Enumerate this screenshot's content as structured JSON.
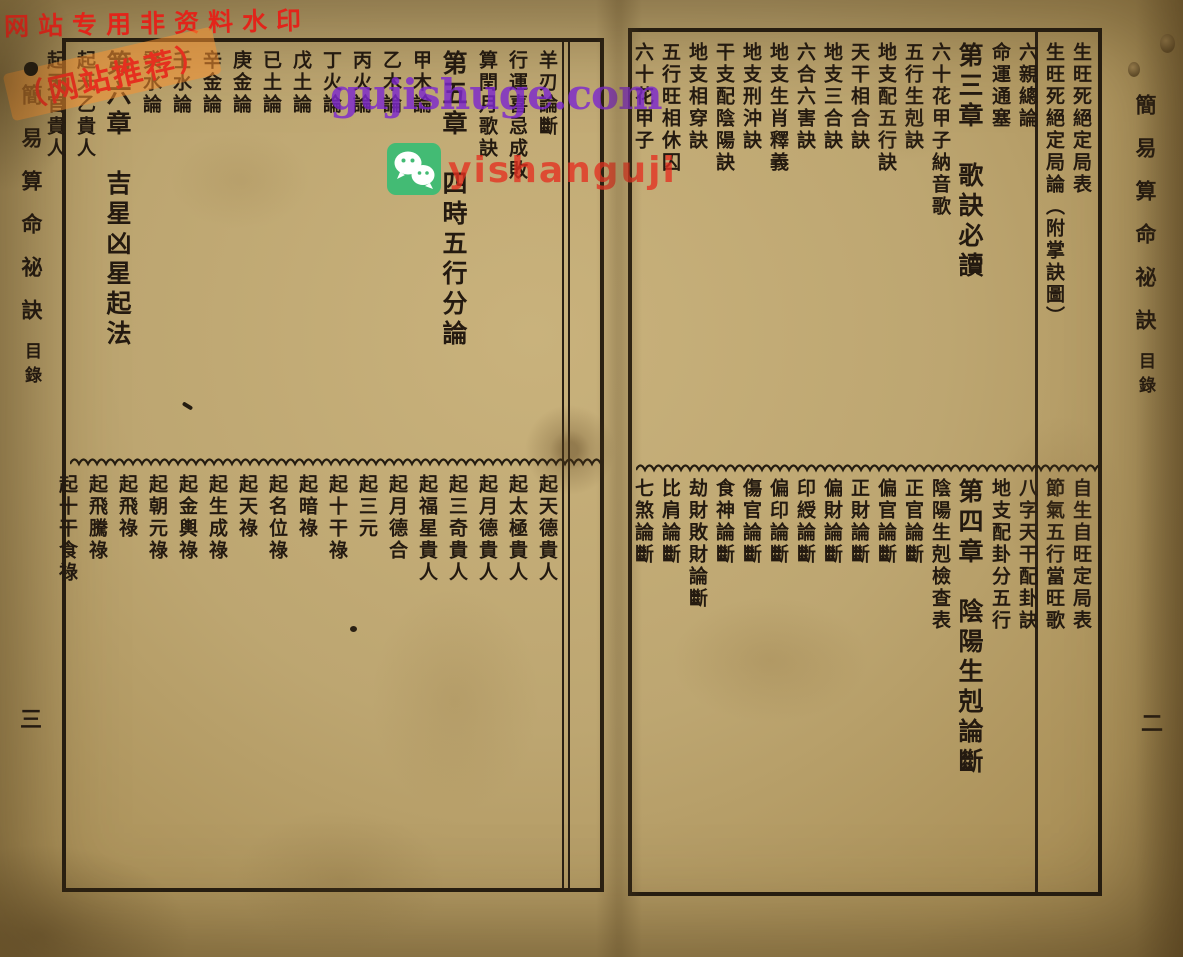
{
  "book": {
    "margin_title": "簡易算命祕訣",
    "margin_subtitle": "目錄",
    "left_page_number": "三",
    "right_page_number": "二"
  },
  "right_page": {
    "top_entries": [
      "生旺死絕定局表",
      "生旺死絕定局論（附掌訣圖）",
      "六親總論",
      "命運通塞",
      "第三章　歌訣必讀",
      "六十花甲子納音歌",
      "五行生剋訣",
      "地支配五行訣",
      "天干相合訣",
      "地支三合訣",
      "六合六害訣",
      "地支生肖釋義",
      "地支刑沖訣",
      "干支配陰陽訣",
      "地支相穿訣",
      "五行旺相休囚",
      "六十花甲子"
    ],
    "bottom_entries": [
      "自生自旺定局表",
      "節氣五行當旺歌",
      "八字天干配卦訣",
      "地支配卦分五行",
      "第四章　陰陽生剋論斷",
      "陰陽生剋檢查表",
      "正官論斷",
      "偏官論斷",
      "正財論斷",
      "偏財論斷",
      "印綬論斷",
      "偏印論斷",
      "傷官論斷",
      "食神論斷",
      "劫財敗財論斷",
      "比肩論斷",
      "七煞論斷"
    ]
  },
  "left_page": {
    "top_entries": [
      "羊刃論斷",
      "行運喜忌成敗",
      "算閏月歌訣",
      "第五章　四時五行分論",
      "甲木論",
      "乙木論",
      "丙火論",
      "丁火論",
      "戊土論",
      "已土論",
      "庚金論",
      "辛金論",
      "壬水論",
      "癸水論",
      "第六章　吉星凶星起法",
      "起天乙貴人",
      "起天官貴人"
    ],
    "bottom_entries": [
      "起天德貴人",
      "起太極貴人",
      "起月德貴人",
      "起三奇貴人",
      "起福星貴人",
      "起月德合",
      "起三元",
      "起十干祿",
      "起暗祿",
      "起名位祿",
      "起天祿",
      "起生成祿",
      "起金輿祿",
      "起朝元祿",
      "起飛祿",
      "起飛騰祿",
      "起十干食祿"
    ]
  },
  "watermarks": {
    "top_left_text": "网站专用非资料水印",
    "recommend_text": "（网站推荐）",
    "site_url": "gujishuge.com",
    "wechat_id": "yishanguji",
    "colors": {
      "purple": "#7c28cd",
      "red": "#e5301f",
      "orange_band": "rgba(246,146,50,0.55)",
      "wechat_green": "#43bb74",
      "paper": "#bda671",
      "ink": "#241a10"
    }
  }
}
